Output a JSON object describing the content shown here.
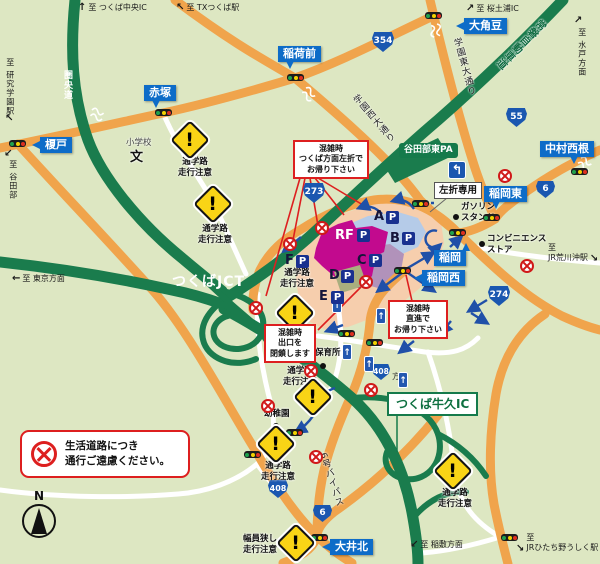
{
  "colors": {
    "background": "#dde7c2",
    "road_orange": "#f0a44c",
    "expressway_green": "#1a7c4d",
    "label_blue": "#0d6cc8",
    "shield_blue": "#1a57b0",
    "callout_red": "#dd1f1f",
    "mall_peach": "#f6cead",
    "mall_magenta": "#c20a8e",
    "mall_lake_blue": "#b5cbe8",
    "mall_mauve": "#b192ba",
    "mall_olive": "#a9ae7e",
    "warning_yellow": "#f9d416",
    "parking_navy": "#19308f"
  },
  "icons": {
    "arrow_up": "↑",
    "arrow_up_left": "↖",
    "arrow_up_right": "↗",
    "arrow_left": "←",
    "arrow_down_left": "↙",
    "arrow_down_right": "↘",
    "one_way_arrow": "↑",
    "left_turn_arrow": "↰",
    "warning_exclaim": "!",
    "north": "N"
  },
  "destinations": {
    "tsukuba_chuo_ic": "至 つくば中央IC",
    "tx_tsukuba_station": "至 TXつくば駅",
    "sakura_tsuchiura_ic": "至 桜土浦IC",
    "mito_area": "至 水戸方面",
    "kenkyu_gakuen_station": "至 研究学園駅",
    "yatabe": "至 谷田部",
    "tokyo_area": "至 東京方面",
    "jr_arakawaoki_station": "至\nJR荒川沖駅",
    "inashiki_area": "至 稲敷方面",
    "jr_hitachino_ushiku_station": "至\nJRひたち野うしく駅"
  },
  "intersections": {
    "inarimae": "稲荷前",
    "sasagi": "大角豆",
    "akatsuka": "赤塚",
    "enokido": "榎戸",
    "nakamura_nishine": "中村西根",
    "inaoka_higashi": "稲岡東",
    "inaoka": "稲岡",
    "inaoka_nishi": "稲岡西",
    "oi_kita": "大井北"
  },
  "junctions": {
    "tsukuba_jct": "つくばJCT",
    "tsukuba_ushiku_ic": "つくば牛久IC",
    "yatabe_higashi_pa": "谷田部東PA"
  },
  "roads": {
    "kenodo": "圏央道",
    "joban_expressway": "常磐自動車道",
    "gakuen_higashi_odori": "学園東大通り",
    "gakuen_nishi_odori": "学園西大通り",
    "bypass_6": "6号バイパス",
    "homen_suffix": "方面",
    "route_354": "354",
    "route_55": "55",
    "route_6": "6",
    "route_273": "273",
    "route_274": "274",
    "route_408": "408"
  },
  "facilities": {
    "elementary_school": "小学校",
    "school_map_symbol": "文",
    "gas_station": "ガソリン\nスタンド",
    "convenience_store": "コンビニエンス\nストア",
    "nursery": "保育所",
    "kindergarten": "幼稚園"
  },
  "warnings": {
    "school_route": "通学路\n走行注意",
    "narrow_road": "幅員狭し\n走行注意"
  },
  "notices": {
    "left_turn_only": "左折専用",
    "congestion_left_turn": "混雑時\nつくば方面左折で\nお帰り下さい",
    "congestion_exit_closed": "混雑時\n出口を\n閉鎖します",
    "congestion_go_straight": "混雑時\n直進で\nお帰り下さい",
    "local_road_notice": "生活道路につき\n通行ご遠慮ください。"
  },
  "parking": {
    "p_mark": "P",
    "lot_a": "A",
    "lot_b": "B",
    "lot_c": "C",
    "lot_d": "D",
    "lot_e": "E",
    "lot_f": "F",
    "lot_rf": "RF"
  }
}
